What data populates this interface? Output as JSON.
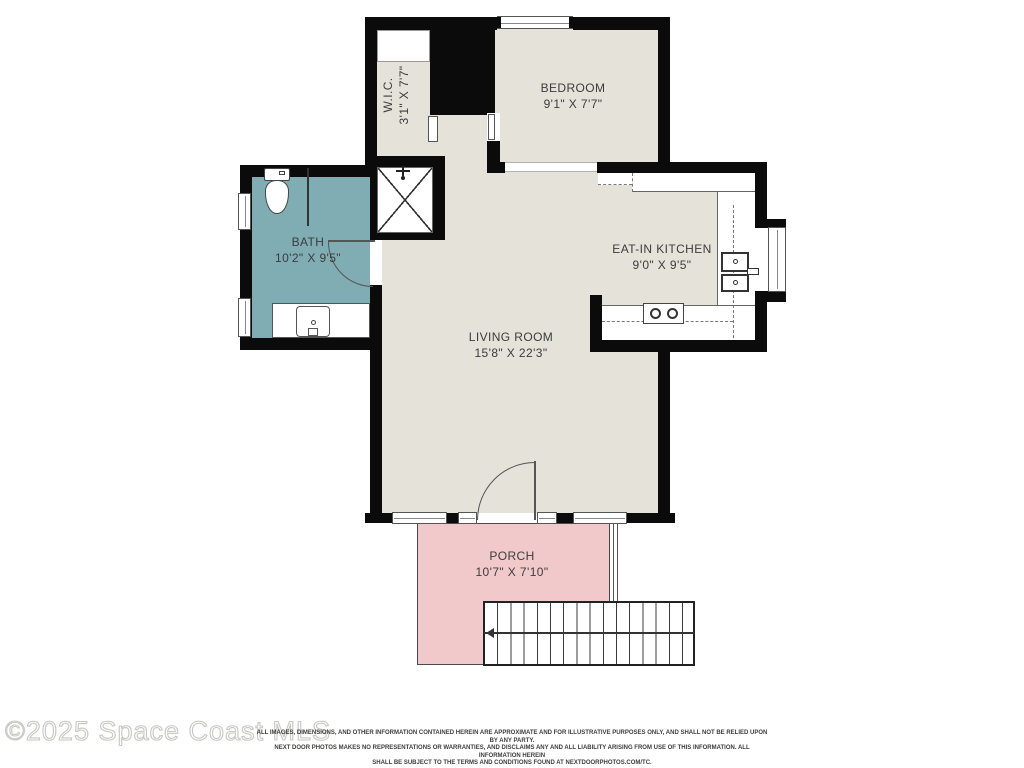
{
  "plan": {
    "rooms": {
      "wic": {
        "name": "W.I.C.",
        "dims": "3'1\" X 7'7\""
      },
      "bedroom": {
        "name": "BEDROOM",
        "dims": "9'1\" X 7'7\""
      },
      "bath": {
        "name": "BATH",
        "dims": "10'2\" X 9'5\""
      },
      "kitchen": {
        "name": "EAT-IN KITCHEN",
        "dims": "9'0\" X 9'5\""
      },
      "living": {
        "name": "LIVING ROOM",
        "dims": "15'8\" X 22'3\""
      },
      "porch": {
        "name": "PORCH",
        "dims": "10'7\" X 7'10\""
      }
    },
    "colors": {
      "wall": "#0b0b0b",
      "floor": "#e4e2d9",
      "bath_floor": "#7fadb3",
      "porch_floor": "#f2c9cb"
    }
  },
  "footer": {
    "watermark": "©2025 Space Coast MLS",
    "disclaimer_lines": [
      "ALL IMAGES, DIMENSIONS, AND OTHER INFORMATION CONTAINED HEREIN ARE APPROXIMATE AND FOR ILLUSTRATIVE PURPOSES ONLY, AND SHALL NOT BE RELIED UPON BY ANY PARTY.",
      "NEXT DOOR PHOTOS MAKES NO REPRESENTATIONS OR WARRANTIES, AND DISCLAIMS ANY AND ALL LIABILITY ARISING FROM USE OF THIS INFORMATION. ALL INFORMATION HEREIN",
      "SHALL BE SUBJECT TO THE TERMS AND CONDITIONS FOUND AT NEXTDOORPHOTOS.COM/TC."
    ]
  }
}
